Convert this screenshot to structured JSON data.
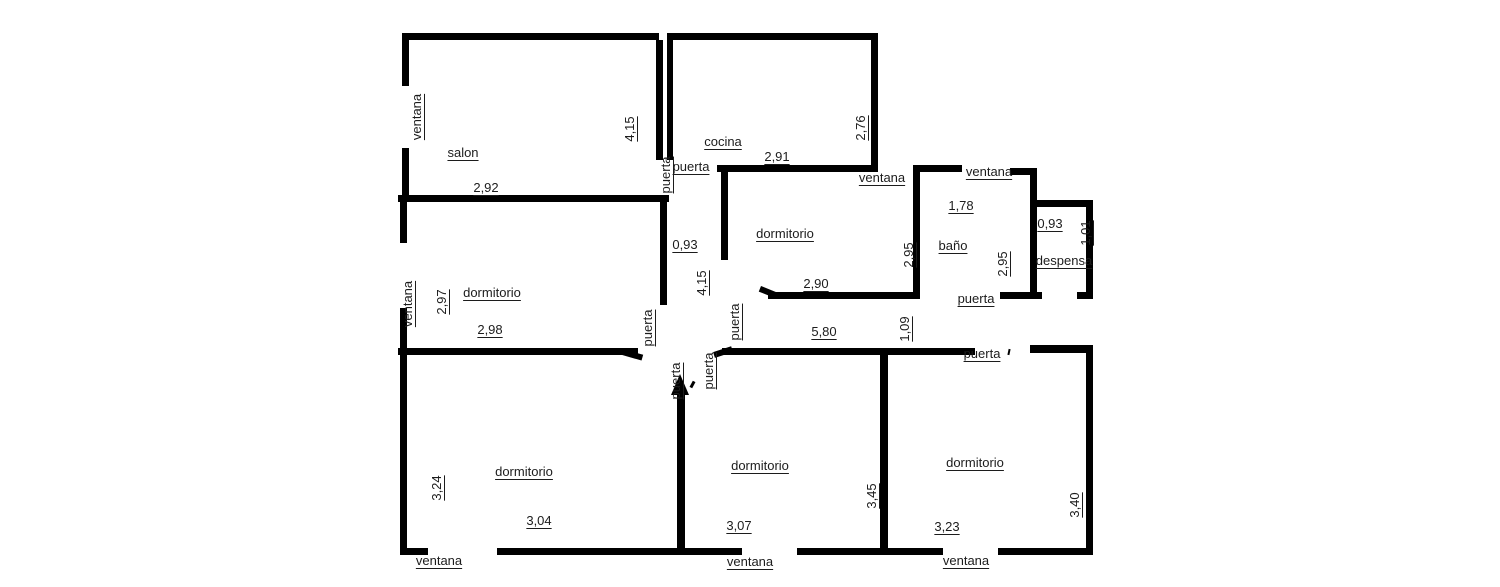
{
  "page": {
    "background": "#ffffff",
    "wall_color": "#000000",
    "text_color": "#1c1c1c"
  },
  "floorplan": {
    "labels": [
      {
        "name": "salon-window-label",
        "text": "ventana",
        "x": 417,
        "y": 117,
        "rot": 1
      },
      {
        "name": "salon-label",
        "text": "salon",
        "x": 463,
        "y": 153,
        "rot": 0
      },
      {
        "name": "salon-width-dim",
        "text": "2,92",
        "x": 486,
        "y": 188,
        "rot": 0
      },
      {
        "name": "salon-height-dim",
        "text": "4,15",
        "x": 630,
        "y": 129,
        "rot": 1
      },
      {
        "name": "salon-door-label",
        "text": "puerta",
        "x": 666,
        "y": 175,
        "rot": 1
      },
      {
        "name": "cocina-door-label",
        "text": "puerta",
        "x": 691,
        "y": 167,
        "rot": 0
      },
      {
        "name": "cocina-label",
        "text": "cocina",
        "x": 723,
        "y": 142,
        "rot": 0
      },
      {
        "name": "cocina-width-dim",
        "text": "2,91",
        "x": 777,
        "y": 157,
        "rot": 0
      },
      {
        "name": "cocina-height-dim",
        "text": "2,76",
        "x": 861,
        "y": 128,
        "rot": 1
      },
      {
        "name": "dormitorio1-window-label",
        "text": "ventana",
        "x": 882,
        "y": 178,
        "rot": 0
      },
      {
        "name": "bano-window-label",
        "text": "ventana",
        "x": 989,
        "y": 172,
        "rot": 0
      },
      {
        "name": "dormitorio1-label",
        "text": "dormitorio",
        "x": 785,
        "y": 234,
        "rot": 0
      },
      {
        "name": "bano-width-dim",
        "text": "1,78",
        "x": 961,
        "y": 206,
        "rot": 0
      },
      {
        "name": "bano-label",
        "text": "baño",
        "x": 953,
        "y": 246,
        "rot": 0
      },
      {
        "name": "dormitorio1-height-dim",
        "text": "2,95",
        "x": 909,
        "y": 255,
        "rot": 1
      },
      {
        "name": "bano-height-dim",
        "text": "2,95",
        "x": 1003,
        "y": 264,
        "rot": 1
      },
      {
        "name": "despensa-width-dim",
        "text": "0,93",
        "x": 1050,
        "y": 224,
        "rot": 0
      },
      {
        "name": "despensa-height-dim",
        "text": "1,01",
        "x": 1086,
        "y": 233,
        "rot": 1
      },
      {
        "name": "despensa-label",
        "text": "despensa",
        "x": 1064,
        "y": 261,
        "rot": 0
      },
      {
        "name": "bano-door-label",
        "text": "puerta",
        "x": 976,
        "y": 299,
        "rot": 0
      },
      {
        "name": "dormitorio1-width-dim",
        "text": "2,90",
        "x": 816,
        "y": 284,
        "rot": 0
      },
      {
        "name": "hall-width-dim",
        "text": "0,93",
        "x": 685,
        "y": 245,
        "rot": 0
      },
      {
        "name": "hall-length-dim",
        "text": "4,15",
        "x": 702,
        "y": 283,
        "rot": 1
      },
      {
        "name": "dormitorio2-label",
        "text": "dormitorio",
        "x": 492,
        "y": 293,
        "rot": 0
      },
      {
        "name": "dormitorio2-height-dim",
        "text": "2,97",
        "x": 442,
        "y": 302,
        "rot": 1
      },
      {
        "name": "dormitorio2-window-label",
        "text": "ventana",
        "x": 408,
        "y": 304,
        "rot": 1
      },
      {
        "name": "dormitorio2-width-dim",
        "text": "2,98",
        "x": 490,
        "y": 330,
        "rot": 0
      },
      {
        "name": "dormitorio2-door-label",
        "text": "puerta",
        "x": 648,
        "y": 328,
        "rot": 1
      },
      {
        "name": "dormitorio1-door-label",
        "text": "puerta",
        "x": 735,
        "y": 322,
        "rot": 1
      },
      {
        "name": "corridor-length-dim",
        "text": "5,80",
        "x": 824,
        "y": 332,
        "rot": 0
      },
      {
        "name": "corridor-width-dim",
        "text": "1,09",
        "x": 905,
        "y": 329,
        "rot": 1
      },
      {
        "name": "entry-door-label",
        "text": "puerta",
        "x": 982,
        "y": 354,
        "rot": 0
      },
      {
        "name": "dormitorio4-door-label",
        "text": "puerta",
        "x": 709,
        "y": 371,
        "rot": 1
      },
      {
        "name": "dormitorio3-door-label",
        "text": "puerta",
        "x": 676,
        "y": 381,
        "rot": 1
      },
      {
        "name": "dormitorio3-label",
        "text": "dormitorio",
        "x": 524,
        "y": 472,
        "rot": 0
      },
      {
        "name": "dormitorio3-height-dim",
        "text": "3,24",
        "x": 437,
        "y": 488,
        "rot": 1
      },
      {
        "name": "dormitorio3-width-dim",
        "text": "3,04",
        "x": 539,
        "y": 521,
        "rot": 0
      },
      {
        "name": "dormitorio3-window-label",
        "text": "ventana",
        "x": 439,
        "y": 561,
        "rot": 0
      },
      {
        "name": "dormitorio4-label",
        "text": "dormitorio",
        "x": 760,
        "y": 466,
        "rot": 0
      },
      {
        "name": "dormitorio4-width-dim",
        "text": "3,07",
        "x": 739,
        "y": 526,
        "rot": 0
      },
      {
        "name": "dormitorio4-height-dim",
        "text": "3,45",
        "x": 872,
        "y": 496,
        "rot": 1
      },
      {
        "name": "dormitorio4-window-label",
        "text": "ventana",
        "x": 750,
        "y": 562,
        "rot": 0
      },
      {
        "name": "dormitorio5-label",
        "text": "dormitorio",
        "x": 975,
        "y": 463,
        "rot": 0
      },
      {
        "name": "dormitorio5-width-dim",
        "text": "3,23",
        "x": 947,
        "y": 527,
        "rot": 0
      },
      {
        "name": "dormitorio5-height-dim",
        "text": "3,40",
        "x": 1075,
        "y": 505,
        "rot": 1
      },
      {
        "name": "dormitorio5-window-label",
        "text": "ventana",
        "x": 966,
        "y": 561,
        "rot": 0
      }
    ]
  }
}
